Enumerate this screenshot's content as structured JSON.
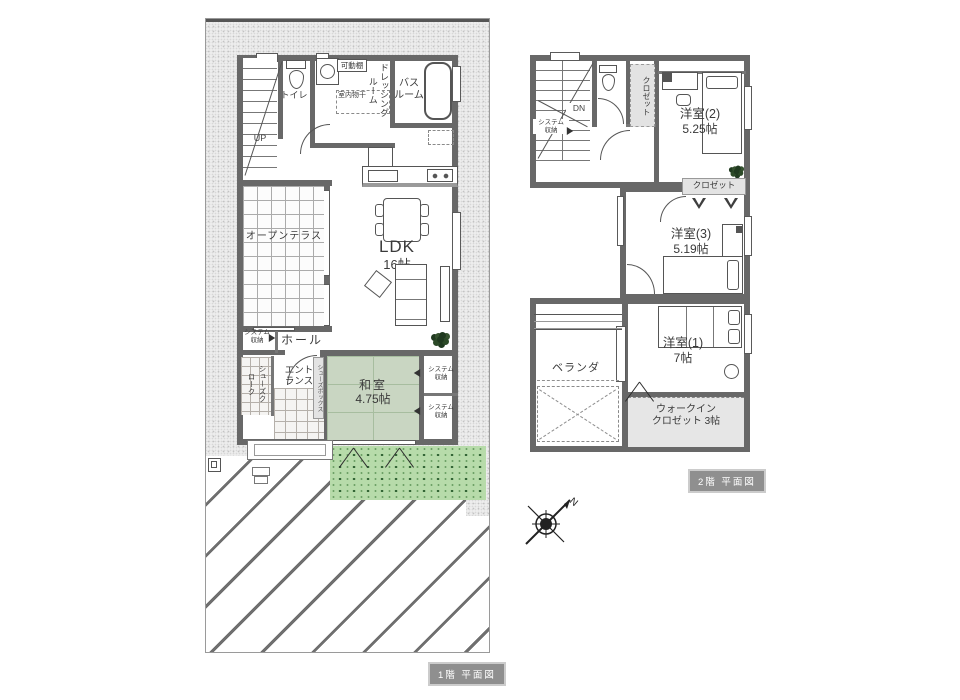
{
  "title": "住宅 間取り図(1階・2階 平面図)",
  "colors": {
    "wall": "#686868",
    "site": "#ededed",
    "tatami": "#c9d6c2",
    "grass": "#b7dbaa",
    "grass_dot": "#2f6233",
    "label_bg": "#e3e3e3",
    "badge_bg": "#8f8f8f",
    "line": "#555555"
  },
  "floor1": {
    "badge": "1階 平面図",
    "stairs_label": "UP",
    "toilet": "トイレ",
    "movable_shelf": "可動棚",
    "indoor_drying": "室内物干",
    "dressing_room": "ドレッシングルーム",
    "bathroom_l1": "バス",
    "bathroom_l2": "ルーム",
    "ldk_l1": "LDK",
    "ldk_l2": "16帖",
    "open_terrace": "オープンテラス",
    "system_storage_l1": "システム",
    "system_storage_l2": "収納",
    "hall": "ホール",
    "shoes_cloak": "シューズクローク",
    "entrance_l1": "エント",
    "entrance_l2": "ランス",
    "shoe_box": "シューズボックス",
    "washitsu_l1": "和室",
    "washitsu_l2": "4.75帖"
  },
  "floor2": {
    "badge": "2階 平面図",
    "stairs_label": "DN",
    "system_storage_l1": "システム",
    "system_storage_l2": "収納",
    "closet_vertical": "クロゼット",
    "flat_roof": "フラットルーフ",
    "room2_l1": "洋室(2)",
    "room2_l2": "5.25帖",
    "closet_box": "クロゼット",
    "room3_l1": "洋室(3)",
    "room3_l2": "5.19帖",
    "veranda": "ベランダ",
    "room1_l1": "洋室(1)",
    "room1_l2": "7帖",
    "wic_l1": "ウォークイン",
    "wic_l2": "クロゼット 3帖",
    "compass_n": "N"
  }
}
